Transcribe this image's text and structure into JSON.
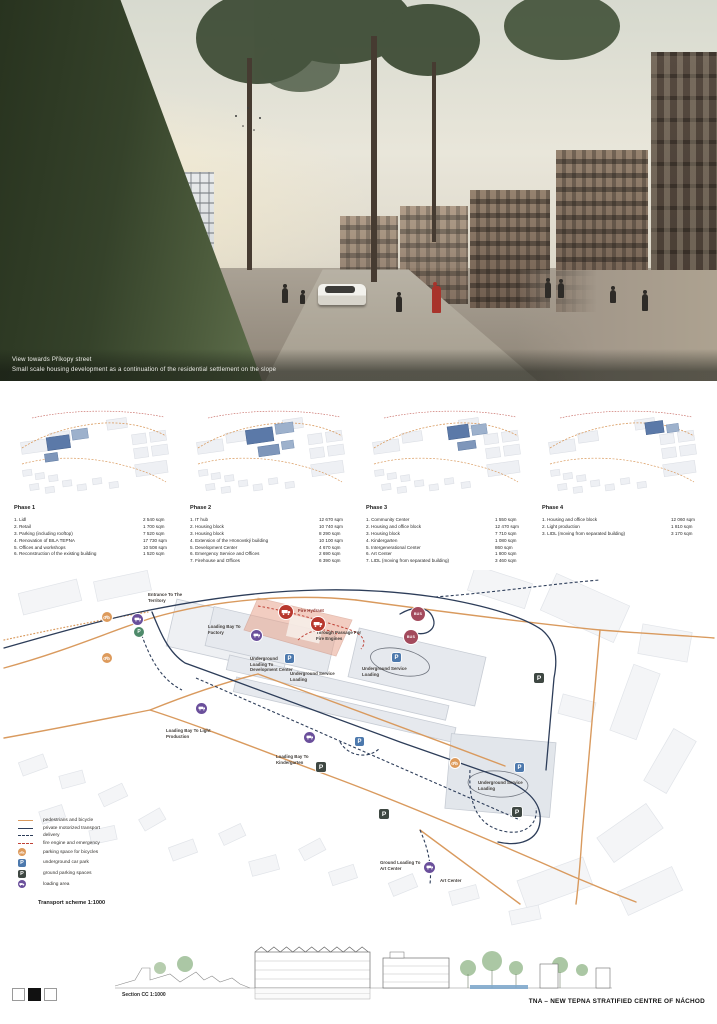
{
  "hero": {
    "caption_line1": "View towards Příkopy street",
    "caption_line2": "Small scale housing development as a continuation of the residential settlement on the slope"
  },
  "phases": [
    {
      "title": "Phase 1",
      "items": [
        {
          "label": "1. Lidl",
          "value": "2 540 sqm"
        },
        {
          "label": "2. Retail",
          "value": "1 700 sqm"
        },
        {
          "label": "3. Parking (including rooftop)",
          "value": "7 520 sqm"
        },
        {
          "label": "4. Renovation of BILA TEPNA",
          "value": "17 730 sqm"
        },
        {
          "label": "5. Offices and workshops",
          "value": "10 508 sqm"
        },
        {
          "label": "6. Reconstruction of the existing building",
          "value": "1 520 sqm"
        }
      ]
    },
    {
      "title": "Phase 2",
      "items": [
        {
          "label": "1. IT hub",
          "value": "12 670 sqm"
        },
        {
          "label": "2. Housing block",
          "value": "10 740 sqm"
        },
        {
          "label": "3. Housing block",
          "value": "8 290 sqm"
        },
        {
          "label": "4. Extension of the Hronovský building",
          "value": "10 100 sqm"
        },
        {
          "label": "5. Development Center",
          "value": "4 670 sqm"
        },
        {
          "label": "6. Emergency Service and Offices",
          "value": "2 690 sqm"
        },
        {
          "label": "7. Firehouse and Offices",
          "value": "6 390 sqm"
        }
      ]
    },
    {
      "title": "Phase 3",
      "items": [
        {
          "label": "1. Community Center",
          "value": "1 550 sqm"
        },
        {
          "label": "2. Housing and office block",
          "value": "12 470 sqm"
        },
        {
          "label": "3. Housing block",
          "value": "7 710 sqm"
        },
        {
          "label": "4. Kindergarten",
          "value": "1 080 sqm"
        },
        {
          "label": "5. Intergenerational Center",
          "value": "860 sqm"
        },
        {
          "label": "6. Art Center",
          "value": "1 800 sqm"
        },
        {
          "label": "7. LIDL (moving from separated building)",
          "value": "3 460 sqm"
        }
      ]
    },
    {
      "title": "Phase 4",
      "items": [
        {
          "label": "1. Housing and office block",
          "value": "12 060 sqm"
        },
        {
          "label": "2. Light production",
          "value": "1 810 sqm"
        },
        {
          "label": "3. LIDL (moving from separated building)",
          "value": "3 170 sqm"
        }
      ]
    }
  ],
  "map": {
    "labels": [
      "Entrance To The Territory",
      "Loading Bay To Factory",
      "Fire Hydrant",
      "Through Passage For Fire Engines",
      "Underground Loading To Development Center",
      "Underground Service Loading",
      "Underground Service Loading",
      "Loading Bay To Light Production",
      "Loading Bay To Kindergarten",
      "Underground Service Loading",
      "Ground Loading To Art Center",
      "Art Center"
    ],
    "bus_label": "BUS",
    "p_label": "P",
    "legend": {
      "items": [
        {
          "label": "pedestrians and bicycle"
        },
        {
          "label": "private motorized transport"
        },
        {
          "label": "delivery"
        },
        {
          "label": "fire engine and emergency"
        },
        {
          "label": "parking space for bicycles"
        },
        {
          "label": "underground car park"
        },
        {
          "label": "ground parking spaces"
        },
        {
          "label": "loading area"
        }
      ],
      "scale_label": "Transport scheme 1:1000"
    },
    "accent_colors": {
      "pedestrian_orange": "#d99a5e",
      "motorized_navy": "#2d3d59",
      "fire_red": "#bf4136",
      "loading_purple": "#6a4f9b",
      "underground_blue": "#4d79ad",
      "ground_parking_dark": "#3e4742",
      "bus_maroon": "#a34a5c",
      "bike_orange": "#dd9a5b",
      "phase_highlight_blue": "#5b79a8",
      "fire_zone_pink": "#e9a68f"
    }
  },
  "section": {
    "label": "Section CC 1:1000"
  },
  "footer": {
    "title": "TNA – NEW TEPNA STRATIFIED CENTRE OF NÁCHOD"
  }
}
